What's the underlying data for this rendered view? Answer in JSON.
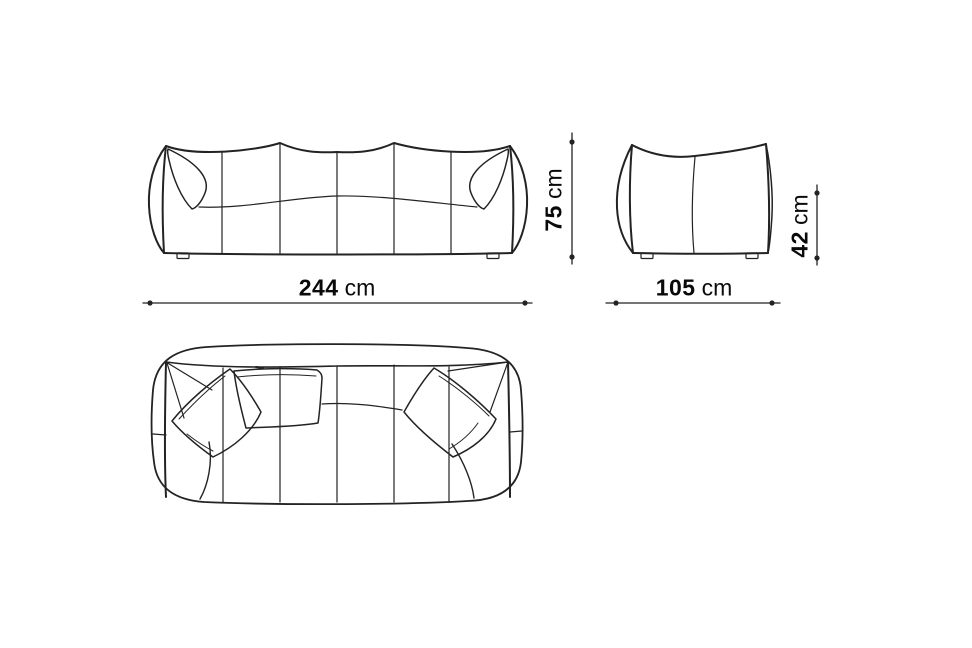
{
  "drawing": {
    "colors": {
      "bg": "#ffffff",
      "line": "#232323",
      "text": "#0a0a0a"
    }
  },
  "dimensions": {
    "overall_width": {
      "value": "244",
      "unit": "cm"
    },
    "overall_height": {
      "value": "75",
      "unit": "cm"
    },
    "overall_depth": {
      "value": "105",
      "unit": "cm"
    },
    "seat_height": {
      "value": "42",
      "unit": "cm"
    }
  }
}
